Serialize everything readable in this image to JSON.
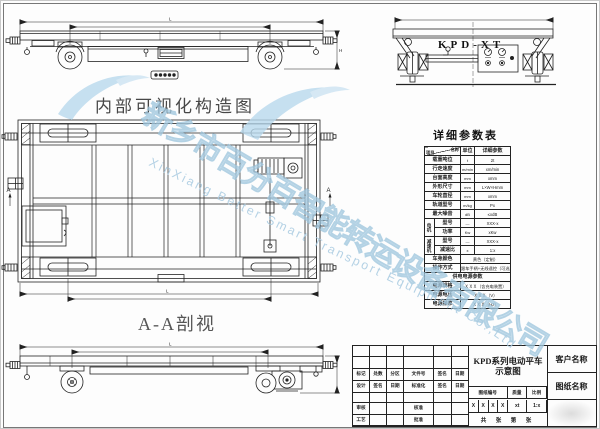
{
  "captions": {
    "internal_view": "内部可视化构造图",
    "section_view": "A-A剖视",
    "table_title": "详细参数表",
    "end_view_model": "KPD-XT",
    "section_marker": "A",
    "dim_length": "L",
    "dim_height": "H"
  },
  "param_table": {
    "header": {
      "item": "项目",
      "name": "名称",
      "unit": "单位",
      "value": "详细参数"
    },
    "rows": [
      {
        "label": "载重吨位",
        "unit": "t",
        "value": "2t"
      },
      {
        "label": "行走速度",
        "unit": "m/min",
        "value": "xm/min"
      },
      {
        "label": "台面高度",
        "unit": "mm",
        "value": "xmm"
      },
      {
        "label": "外形尺寸",
        "unit": "mm",
        "value": "L×W×Hmm"
      },
      {
        "label": "车轮直径",
        "unit": "mm",
        "value": "xmm"
      },
      {
        "label": "轨道型号",
        "unit": "m/kg",
        "value": "Px"
      },
      {
        "label": "最大噪音",
        "unit": "dB",
        "value": "≤xdB"
      }
    ],
    "motor": {
      "group": "电机",
      "rows": [
        {
          "label": "型号",
          "unit": "—",
          "value": "XXX-x"
        },
        {
          "label": "功率",
          "unit": "Kw",
          "value": "xKw"
        }
      ]
    },
    "reducer": {
      "group": "减速机",
      "rows": [
        {
          "label": "型号",
          "unit": "—",
          "value": "XXX-x"
        },
        {
          "label": "减速比",
          "unit": "x",
          "value": "1:x"
        }
      ]
    },
    "wide_rows": [
      {
        "label": "车身颜色",
        "value": "黄色（定制）"
      },
      {
        "label": "操作方式",
        "value": "跟车手柄+无线遥控（可选）"
      }
    ],
    "power_section": {
      "title": "供电电源参数",
      "rows": [
        {
          "label": "电源规格",
          "value": "ＸＸＸ（含充电装置）"
        },
        {
          "label": "电源电压",
          "value": "ＸＸＸ（V）"
        },
        {
          "label": "电源频率",
          "value": "ＸＸＸ（Hz）"
        }
      ]
    }
  },
  "title_block": {
    "product_line1": "KPD系列电动平车",
    "product_line2": "示意图",
    "customer_label": "客户名称",
    "drawing_name_label": "图纸名称",
    "drawing_no_label": "图纸编号",
    "mass_label": "质量",
    "scale_label": "比例",
    "stage_values": [
      "X",
      "X",
      "X",
      "X"
    ],
    "mass_value": "xt",
    "scale_value": "1:x",
    "sheet_label": "共 张 第 张",
    "rev_header": [
      "标记",
      "处数",
      "分区",
      "文件号",
      "签名",
      "日期"
    ],
    "design_row": [
      "设计",
      "签名",
      "日期",
      "标准化",
      "签名",
      "日期"
    ],
    "audit_label": "审核",
    "check_label": "核准",
    "craft_label": "工艺",
    "approve_label": "批准"
  },
  "watermark": {
    "company_cn": "新乡市百分百智能转运设备有限公司",
    "company_en": "XinXiang Better Smart Transport Equipment Co.,Ltd",
    "color": "#a9cce2"
  },
  "colors": {
    "line": "#222222",
    "watermark_fill": "#c9e0f0",
    "watermark_stroke": "#9fc6de"
  }
}
